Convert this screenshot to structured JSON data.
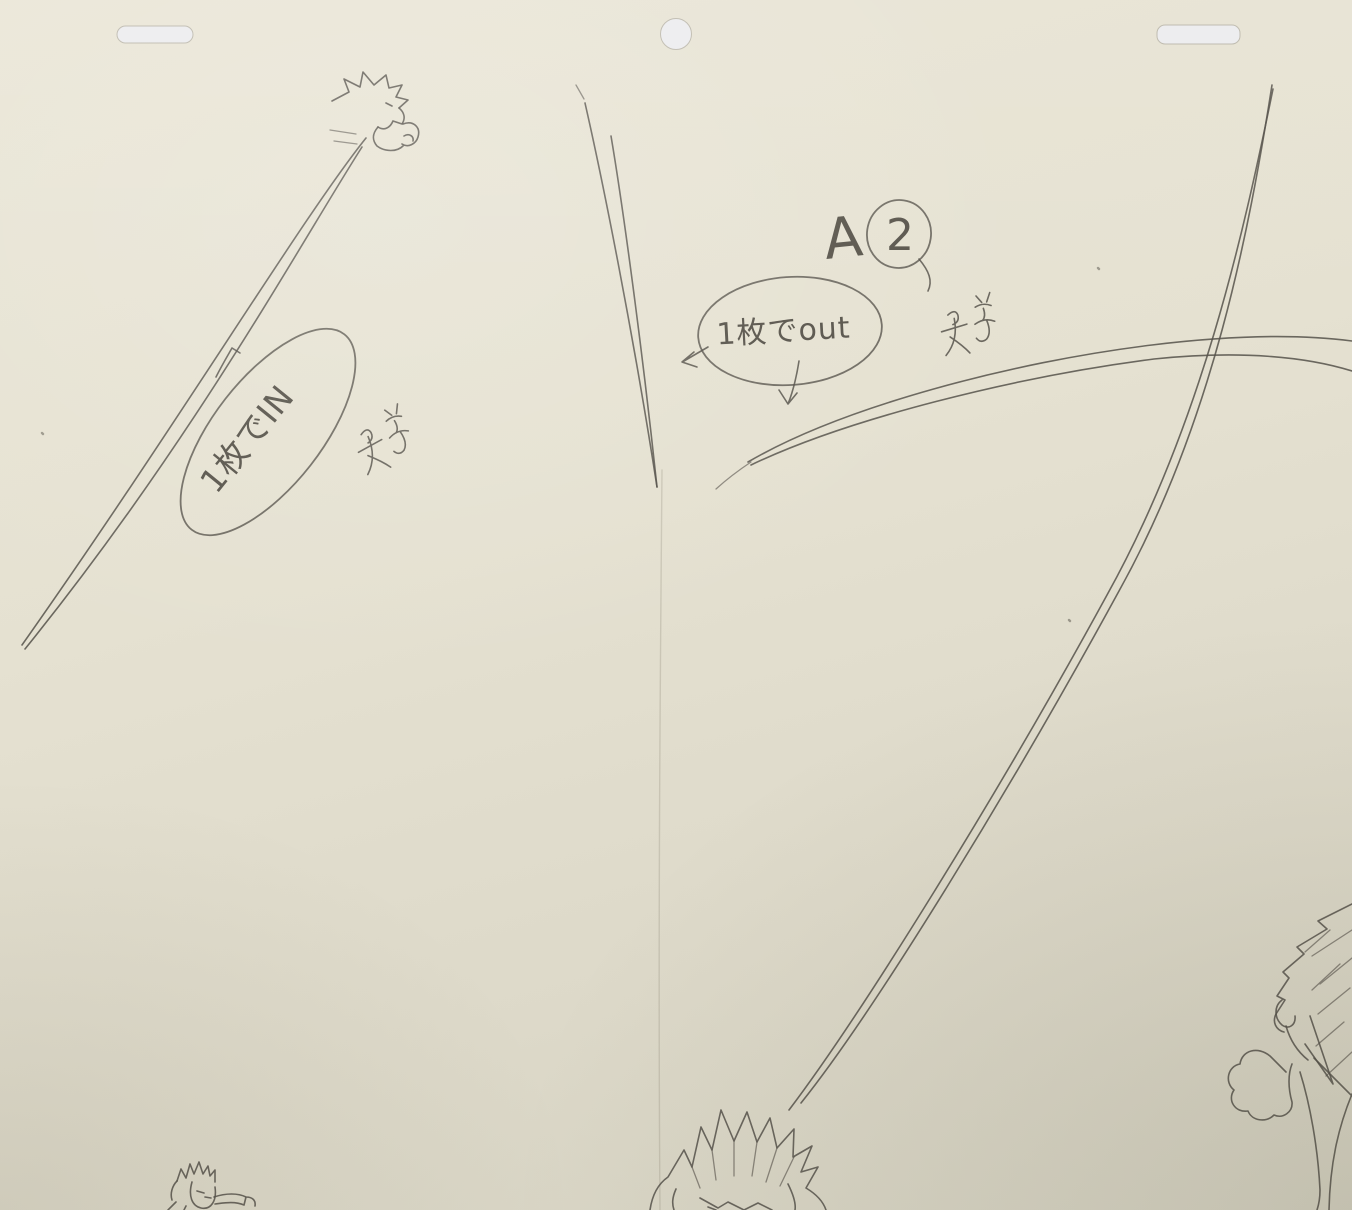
{
  "scene": {
    "type": "photograph of a pencil animation key drawing (genga) on cream animation paper",
    "colors": {
      "paper": "#e5e1d1",
      "paper_shadow": "#d5d2c2",
      "pencil": "#55514a",
      "peg_hole": "#ececee"
    },
    "marks": [
      "small tick mark above the IN note oval",
      "illegible pencil scribble to the right of the IN note oval",
      "illegible pencil scribble below-right of the shot label",
      "small arrowhead pointing left at the out note oval",
      "small down arrow below the out note oval"
    ],
    "sketch_subjects": [
      "tiny spiky-haired flying figure top-left with long motion trail",
      "tapering double motion line center-top",
      "long double-line energy beam sweeping from top-right to bottom-center head",
      "double-line swoosh arc crossing toward right edge",
      "large spiky-haired head bottom-center (cut off)",
      "small spiky-haired figure bottom-left (cut off)",
      "partial spiky-haired figure with fist at right edge (cut off)"
    ]
  },
  "annotations": {
    "shot_label": {
      "letter": "A",
      "number": "2"
    },
    "in_note": "1枚でIN",
    "out_note": "1枚でout"
  },
  "paths": {
    "arc_trail_topleft_1": "M366,138 C302,218 182,418 22,645",
    "arc_trail_topleft_2": "M362,147 C303,239 194,440 25,649",
    "taper_line_center_1": "M585,103 C603,182 633,332 657,487",
    "taper_line_center_2": "M611,136 C623,207 642,347 657,487",
    "taper_line_center_dash": "M576,85 L584,99",
    "arc_beam_right_1": "M1272,85 C1249,232 1213,422 1119,591 C1011,789 874,1012 801,1103",
    "arc_beam_right_2": "M1273,89 C1243,236 1201,426 1107,595 C999,793 861,1015 789,1110",
    "arc_swoosh_1": "M748,462 C842,407 1012,362 1152,345 C1242,334 1306,335 1352,341",
    "arc_swoosh_2": "M751,465 C847,419 1014,377 1154,359 C1242,350 1307,357 1352,371",
    "arc_swoosh_tail": "M716,489 C727,479 739,470 751,462",
    "paper_fold": "M662,470 C660,700 658,950 660,1210",
    "char_topleft_hair": "M332,101 L349,92 L344,79 L360,87 L363,72 L374,85 L386,75 L389,88 L402,85 L396,97 L408,100 L399,108",
    "char_topleft_face": "M399,108 C404,112 406,118 402,124 L393,121 M386,103 L392,106 M393,121 C390,128 384,131 378,127",
    "char_topleft_body": "M378,127 C372,134 372,140 377,146 C385,152 397,152 403,146 M403,124 C413,120 421,127 418,137 C416,144 408,148 402,144 M404,136 C409,133 414,136 413,141",
    "char_topleft_speedlines": "M330,130 L356,134 M334,141 L357,144",
    "tick_mark": "M216,377 C222,365 228,355 232,348 L240,353",
    "scribble_glyph": "M8,18 Q16,12 18,19 Q19,26 12,28 M0,34 L26,29 M14,22 Q16,44 2,58 M8,40 Q20,50 26,58 M38,2 L43,9 M52,0 L48,9 M36,13 Q44,9 52,13 M44,15 Q46,23 42,27 M34,30 Q44,24 54,29 M46,27 Q50,40 44,46 Q38,50 34,44",
    "arrow_left": "M708,347 L684,361 M694,352 L682,362 L697,367",
    "arrow_down": "M799,361 C796,380 792,394 788,404 M788,404 L779,390 M788,404 L797,393",
    "a_circle_tail": "M919,259 C929,271 933,281 928,291",
    "char_bottomcenter_hair": "M650,1210 C652,1196 658,1184 668,1177 L684,1150 L692,1167 L701,1127 L712,1150 L721,1110 L734,1141 L747,1112 L757,1142 L770,1118 L777,1148 L794,1129 L793,1157 L812,1146 L801,1172 L818,1167 L806,1188 C816,1194 823,1201 826,1210",
    "char_bottomcenter_strands": "M712,1150 L716,1180 M734,1141 L734,1176 M757,1142 L752,1176 M777,1148 L766,1182 M794,1157 L780,1186 M692,1167 L700,1188",
    "char_bottomcenter_face": "M676,1189 C672,1198 672,1204 674,1210 M700,1198 L718,1208 L728,1202 L744,1210 M744,1210 L758,1203 L772,1210 M788,1184 C794,1196 796,1204 795,1210 M708,1207 L716,1210",
    "char_bottomleft_hair": "M177,1181 L181,1169 L186,1178 L190,1164 L194,1174 L199,1162 L203,1174 L208,1166 L210,1176 L215,1170 L215,1182",
    "char_bottomleft_face": "M177,1181 C172,1186 170,1194 172,1200 M192,1182 C188,1196 192,1206 201,1208 C211,1210 217,1201 215,1187 M197,1191 L204,1193 M205,1197 L211,1198",
    "char_bottomleft_arm": "M214,1197 C226,1193 238,1193 246,1197 L244,1205 C234,1201 224,1203 215,1204 M246,1197 C252,1197 256,1200 255,1206 M176,1202 L168,1210 M186,1206 L184,1210",
    "char_right_hair_outline": "M1352,904 L1318,921 L1327,929 L1297,947 L1304,954 L1283,972 L1289,978 L1277,996 L1285,1000 L1276,1014 C1272,1022 1276,1030 1284,1032",
    "char_right_hair_strands": "M1352,930 L1312,956 M1352,958 L1320,984 M1350,988 L1318,1014 M1344,1022 L1316,1046 M1352,1052 L1326,1076 M1330,930 L1305,952 M1340,964 L1312,990",
    "char_right_hair_spike": "M1310,1016 L1333,1084 L1305,1044",
    "char_right_ear": "M1282,1000 C1274,1006 1274,1018 1282,1025 C1289,1030 1296,1025 1295,1016",
    "char_right_jaw": "M1286,1026 C1290,1040 1298,1052 1308,1060",
    "char_right_fist": "M1270,1056 C1258,1046 1242,1050 1240,1064 C1228,1066 1224,1082 1234,1090 C1227,1100 1235,1113 1248,1111 C1252,1121 1266,1123 1274,1115 C1283,1119 1293,1112 1292,1102 M1292,1102 C1288,1088 1288,1074 1292,1064 M1270,1056 C1276,1062 1282,1068 1286,1072",
    "char_right_arm": "M1300,1072 C1310,1104 1318,1148 1320,1190 C1320,1197 1319,1204 1317,1210 M1352,1094 C1338,1128 1330,1164 1329,1210 M1314,1058 C1328,1072 1342,1086 1352,1096",
    "dust_specks": "M42,433 L43,434 M1069,620 L1070,621 M1098,268 L1099,269"
  }
}
